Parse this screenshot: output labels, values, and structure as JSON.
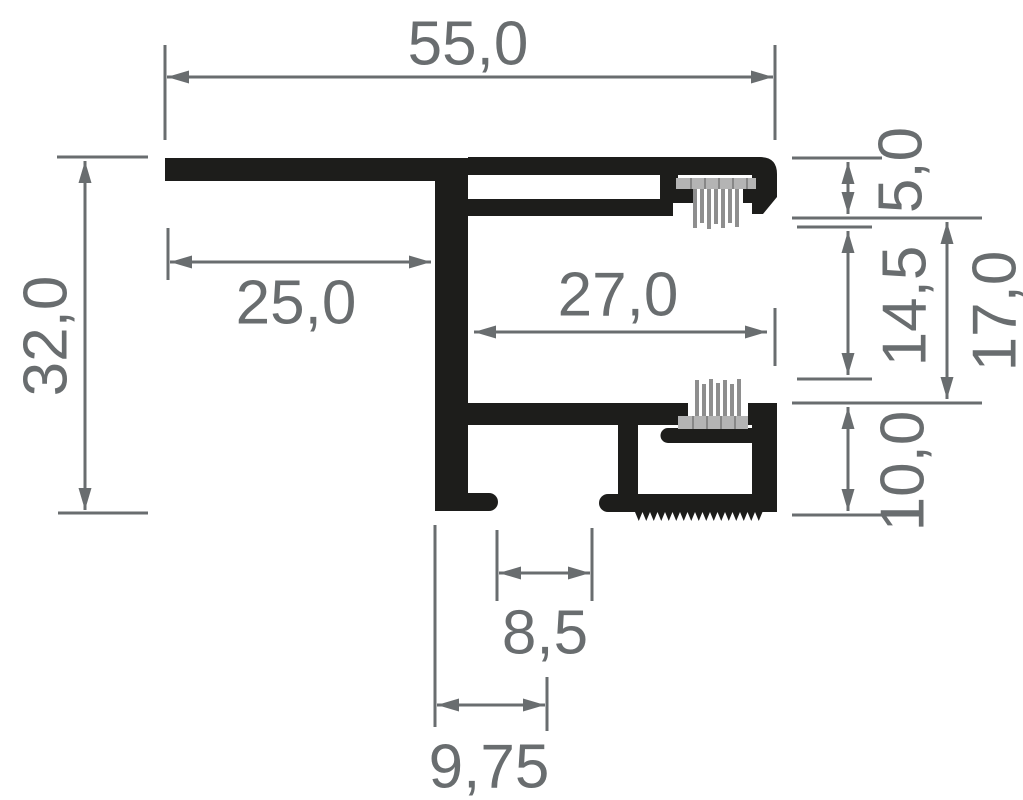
{
  "document": {
    "title": "Aluminium profile cross-section technical drawing",
    "unit": "mm",
    "background_color": "#ffffff"
  },
  "drawing": {
    "style": {
      "profile_color": "#1d1d1b",
      "dimension_color": "#696d6f",
      "brush_backing_color": "#b4b4b4",
      "brush_strand_color": "#8e8e8e"
    },
    "dimensions": {
      "total_width": {
        "label": "55,0",
        "orientation": "horizontal",
        "position": "top"
      },
      "left_flange": {
        "label": "25,0",
        "orientation": "horizontal",
        "position": "upper-left"
      },
      "channel_width": {
        "label": "27,0",
        "orientation": "horizontal",
        "position": "middle"
      },
      "total_height": {
        "label": "32,0",
        "orientation": "vertical",
        "position": "left"
      },
      "top_lip_height": {
        "label": "5,0",
        "orientation": "vertical",
        "position": "right"
      },
      "slot_height": {
        "label": "14,5",
        "orientation": "vertical",
        "position": "right"
      },
      "right_height": {
        "label": "17,0",
        "orientation": "vertical",
        "position": "far-right"
      },
      "base_height": {
        "label": "10,0",
        "orientation": "vertical",
        "position": "right-bottom"
      },
      "foot_gap": {
        "label": "8,5",
        "orientation": "horizontal",
        "position": "bottom"
      },
      "foot_offset": {
        "label": "9,75",
        "orientation": "horizontal",
        "position": "bottom"
      }
    }
  }
}
